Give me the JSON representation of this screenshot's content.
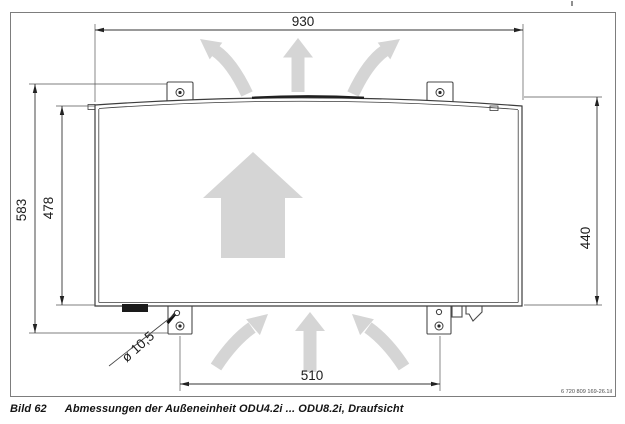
{
  "figure": {
    "label": "Bild 62",
    "caption": "Abmessungen der Außeneinheit ODU4.2i ... ODU8.2i, Draufsicht",
    "reference_number": "6 720 809 169-26.1il"
  },
  "dimensions": {
    "width_overall": "930",
    "depth_overall": "583",
    "depth_body": "478",
    "depth_right": "440",
    "foot_hole_spacing": "510",
    "hole_diameter": "ø 10,5"
  },
  "colors": {
    "airflow_arrow": "#d5d5d5",
    "drawing_line": "#3c3c3c",
    "frame_border": "#7d7d7d"
  }
}
